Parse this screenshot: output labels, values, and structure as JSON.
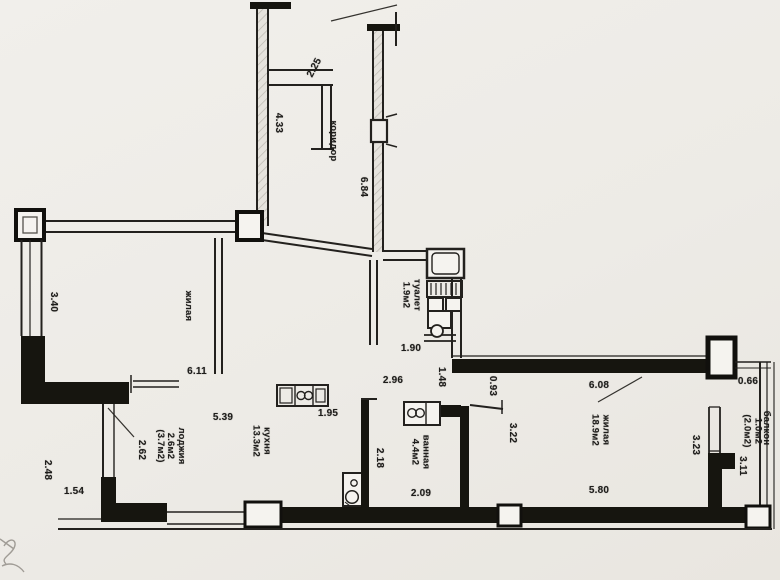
{
  "plan": {
    "rooms": {
      "corridor": {
        "label": "коридор"
      },
      "room2": {
        "label": "жилая"
      },
      "toilet": {
        "label": "туалет",
        "area": "1.9м2"
      },
      "kitchen": {
        "label": "кухня",
        "area": "13.3м2"
      },
      "bathroom": {
        "label": "ванная",
        "area": "4.4м2"
      },
      "living": {
        "label": "жилая",
        "area": "18.9м2"
      },
      "loggia": {
        "label": "лоджия",
        "area": "2.6м2",
        "area_alt": "(3.7м2)"
      },
      "balcony": {
        "label": "балкон",
        "area": "1.0м2",
        "area_alt": "(2.0м2)"
      }
    },
    "dimensions": {
      "niche_top": "2.25",
      "corridor_upper": "4.33",
      "corridor_length": "6.84",
      "toilet_width": "1.90",
      "hall_width": "2.96",
      "hall_depth": "1.48",
      "living_entry": "0.93",
      "room2_glazing": "3.40",
      "room2_width": "6.11",
      "kitchen_width": "5.39",
      "kitchen_counter": "1.95",
      "kitchen_left_height": "2.62",
      "loggia_height": "2.48",
      "loggia_width": "1.54",
      "bath_height": "2.18",
      "bath_width": "2.09",
      "living_top_width": "6.08",
      "living_left_height": "3.22",
      "living_bottom_width": "5.80",
      "living_right_height": "3.23",
      "balcony_gap": "0.66",
      "balcony_length": "3.11"
    },
    "colors": {
      "wall": "#1c1b18",
      "paper": "#edebe6"
    }
  }
}
